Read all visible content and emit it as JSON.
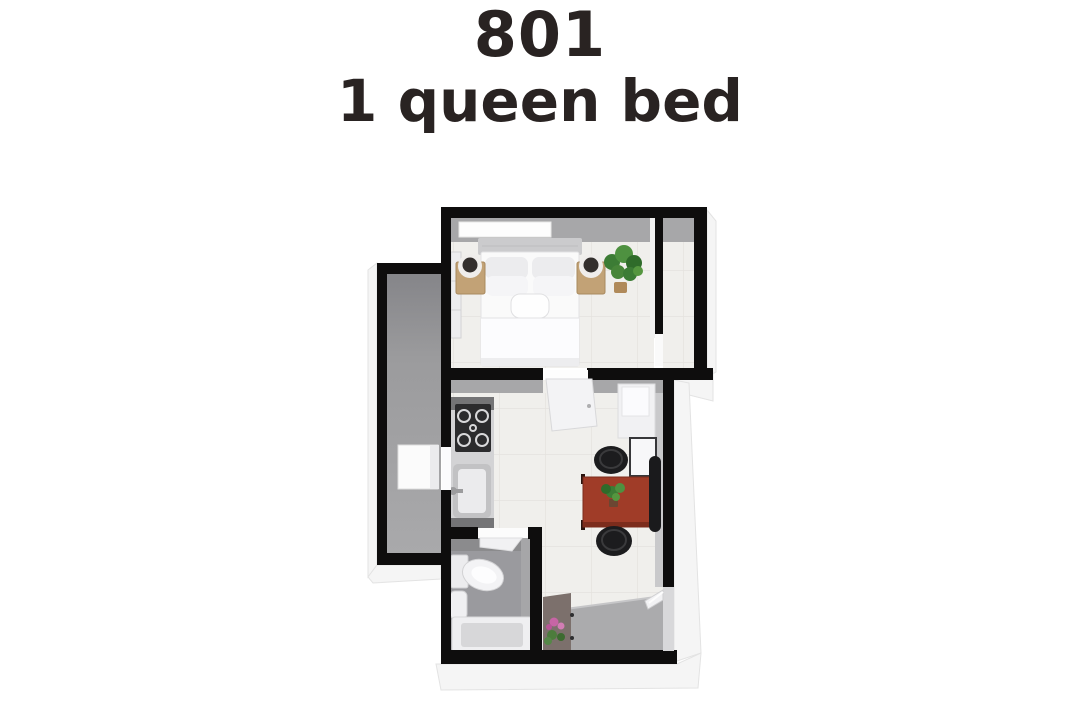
{
  "header": {
    "title": "801",
    "subtitle": "1 queen bed"
  },
  "colors": {
    "text": "#292322",
    "wall": "#0e0d0d",
    "wall_face": "#a7a7a9",
    "floor_tile": "#f0efec",
    "balcony_floor": "#9b9b9d",
    "entry_floor": "#ababad",
    "bathroom_floor": "#9a9a9e",
    "console": "#7c706c",
    "counter_cap": "#747476",
    "counter_body": "#d3d3d5",
    "stove": "#2b2b2d",
    "table_wood": "#a03c28",
    "stool": "#1c1c1e",
    "wood": "#c2a276",
    "headboard": "#cbcbcd",
    "fixture": "#f3f3f5",
    "plant_green": "#3c7c35",
    "orchid_pink": "#c765a5",
    "extrude": "#f5f5f5"
  },
  "floorplan": {
    "rooms": [
      "bedroom",
      "closet",
      "balcony",
      "kitchen-living",
      "bathroom",
      "entry"
    ],
    "furniture": [
      "queen-bed",
      "nightstand-left",
      "nightstand-right",
      "lamp-left",
      "lamp-right",
      "bedroom-plant",
      "wardrobe",
      "stove",
      "kitchen-sink",
      "fridge",
      "side-table",
      "dining-table",
      "stool-top",
      "stool-bottom",
      "side-chair",
      "table-plant",
      "storage-box",
      "toilet",
      "bathroom-sink",
      "bathtub",
      "console-table",
      "orchid"
    ]
  }
}
